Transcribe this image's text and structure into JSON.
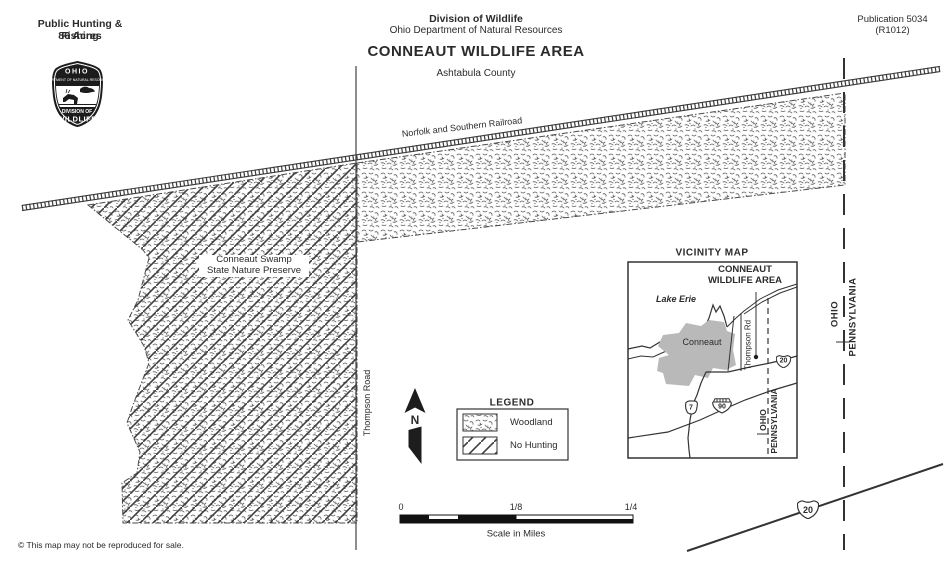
{
  "page": {
    "background": "#ffffff",
    "ink": "#2b2b2b",
    "railroad_color": "#3b3b3b",
    "city_fill": "#b9b9b9"
  },
  "header": {
    "left_line1": "Public Hunting & Fishing",
    "left_line2": "86 Acres",
    "org_line1": "Division of Wildlife",
    "org_line2": "Ohio Department of Natural Resources",
    "title": "CONNEAUT WILDLIFE AREA",
    "county": "Ashtabula County",
    "pub_line1": "Publication 5034",
    "pub_line2": "(R1012)"
  },
  "badge": {
    "state": "OHIO",
    "arc_text": "DEPARTMENT OF NATURAL RESOURCES",
    "division_line1": "DIVISION OF",
    "division_line2": "WILDLIFE"
  },
  "map": {
    "railroad_label": "Norfolk and Southern Railroad",
    "preserve_line1": "Conneaut Swamp",
    "preserve_line2": "State Nature Preserve",
    "road_label": "Thompson Road",
    "state_west": "OHIO",
    "state_east": "PENNSYLVANIA",
    "route_shield": "20"
  },
  "north_arrow": {
    "label": "N"
  },
  "legend": {
    "title": "LEGEND",
    "items": [
      {
        "label": "Woodland",
        "pattern": "woodland-stipple"
      },
      {
        "label": "No Hunting",
        "pattern": "diagonal-hatch"
      }
    ]
  },
  "vicinity": {
    "title": "VICINITY MAP",
    "area_line1": "CONNEAUT",
    "area_line2": "WILDLIFE AREA",
    "lake": "Lake Erie",
    "city": "Conneaut",
    "road": "Thompson Rd",
    "state_west": "OHIO",
    "state_east": "PENNSYLVANIA",
    "shield_us20": "20",
    "shield_oh7": "7",
    "shield_i90": "90"
  },
  "scalebar": {
    "tick_0": "0",
    "tick_mid": "1/8",
    "tick_end": "1/4",
    "caption": "Scale in Miles"
  },
  "footer": {
    "copyright": "© This map may not be reproduced for sale."
  }
}
